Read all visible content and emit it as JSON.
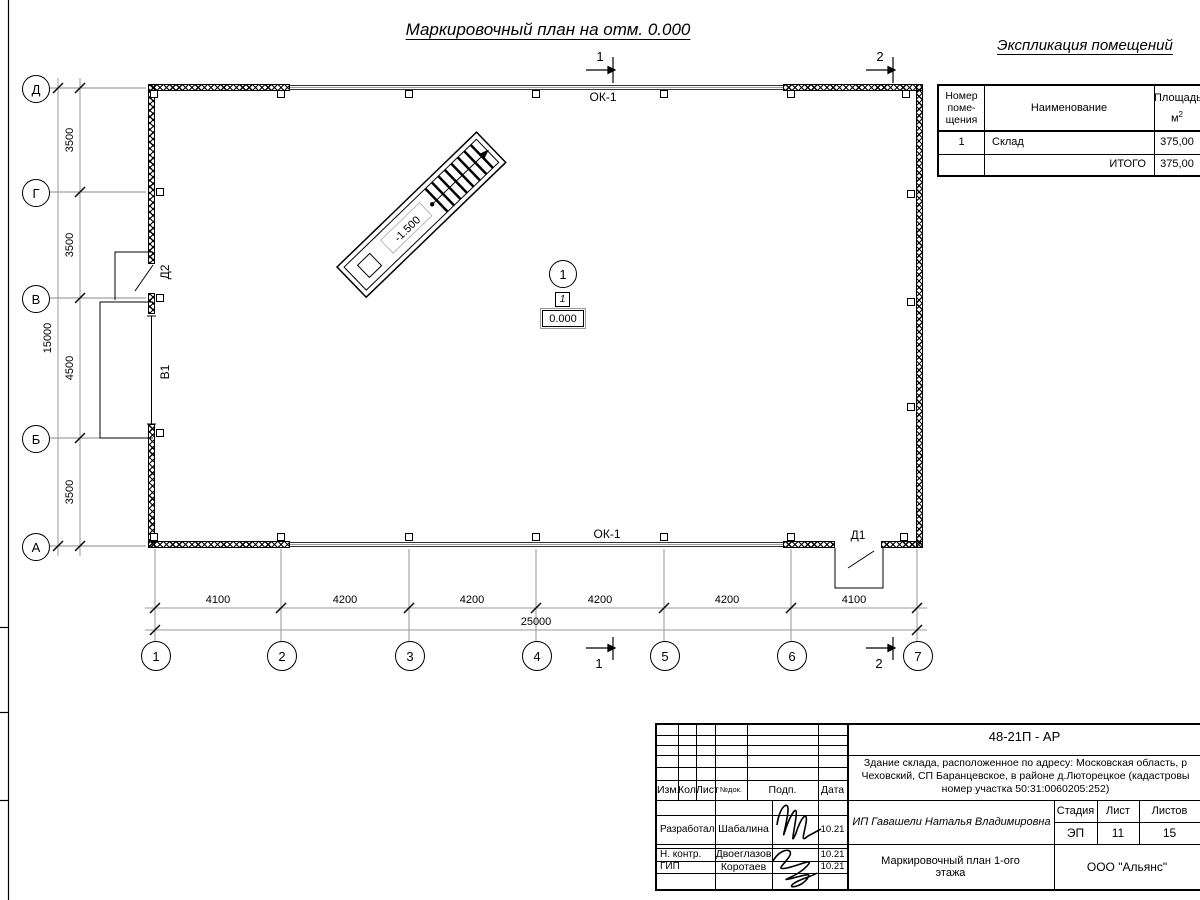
{
  "drawing": {
    "title": "Маркировочный план на отм. 0.000",
    "window_label": "ОК-1",
    "door_d2": "Д2",
    "gate_v1": "В1",
    "door_d1": "Д1",
    "stairs_elevation": "-1.500",
    "room_marker": {
      "number": "1",
      "type": "1",
      "elevation": "0.000"
    },
    "axes_vertical": [
      "Д",
      "Г",
      "В",
      "Б",
      "А"
    ],
    "axes_horizontal": [
      "1",
      "2",
      "3",
      "4",
      "5",
      "6",
      "7"
    ],
    "sections": {
      "s1": "1",
      "s2": "2"
    },
    "dims_bottom": [
      "4100",
      "4200",
      "4200",
      "4200",
      "4200",
      "4100"
    ],
    "dims_bottom_total": "25000",
    "dims_left": [
      "3500",
      "3500",
      "4500",
      "3500"
    ],
    "dims_left_total": "15000"
  },
  "explication": {
    "title": "Экспликация  помещений",
    "col_number_l1": "Номер",
    "col_number_l2": "поме-",
    "col_number_l3": "щения",
    "col_name": "Наименование",
    "col_area": "Площадь,",
    "col_area_unit": "м",
    "col_area_sup": "2",
    "rows": [
      {
        "number": "1",
        "name": "Склад",
        "area": "375,00"
      }
    ],
    "total_label": "ИТОГО",
    "total_area": "375,00"
  },
  "title_block": {
    "code": "48-21П - АР",
    "description_l1": "Здание склада, расположенное по адресу: Московская область, р",
    "description_l2": "Чеховский, СП Баранцевское, в районе д.Люторецкое  (кадастровы",
    "description_l3": "номер участка 50:31:0060205:252)",
    "cols": {
      "izm": "Изм.",
      "kol": "Кол.",
      "list": "Лист",
      "ndok": "№док.",
      "podp": "Подп.",
      "data": "Дата"
    },
    "rows": [
      {
        "role": "Разработал",
        "name": "Шабалина",
        "date": "10.21"
      },
      {
        "role": "Н. контр.",
        "name": "Двоеглазов",
        "date": "10.21"
      },
      {
        "role": "ГИП",
        "name": "Коротаев",
        "date": "10.21"
      }
    ],
    "client": "ИП Гавашели Наталья Владимировна",
    "stage_label": "Стадия",
    "sheet_label": "Лист",
    "sheets_label": "Листов",
    "stage": "ЭП",
    "sheet": "11",
    "sheets": "15",
    "sheet_title_l1": "Маркировочный план 1-ого",
    "sheet_title_l2": "этажа",
    "org": "ООО \"Альянс\""
  }
}
